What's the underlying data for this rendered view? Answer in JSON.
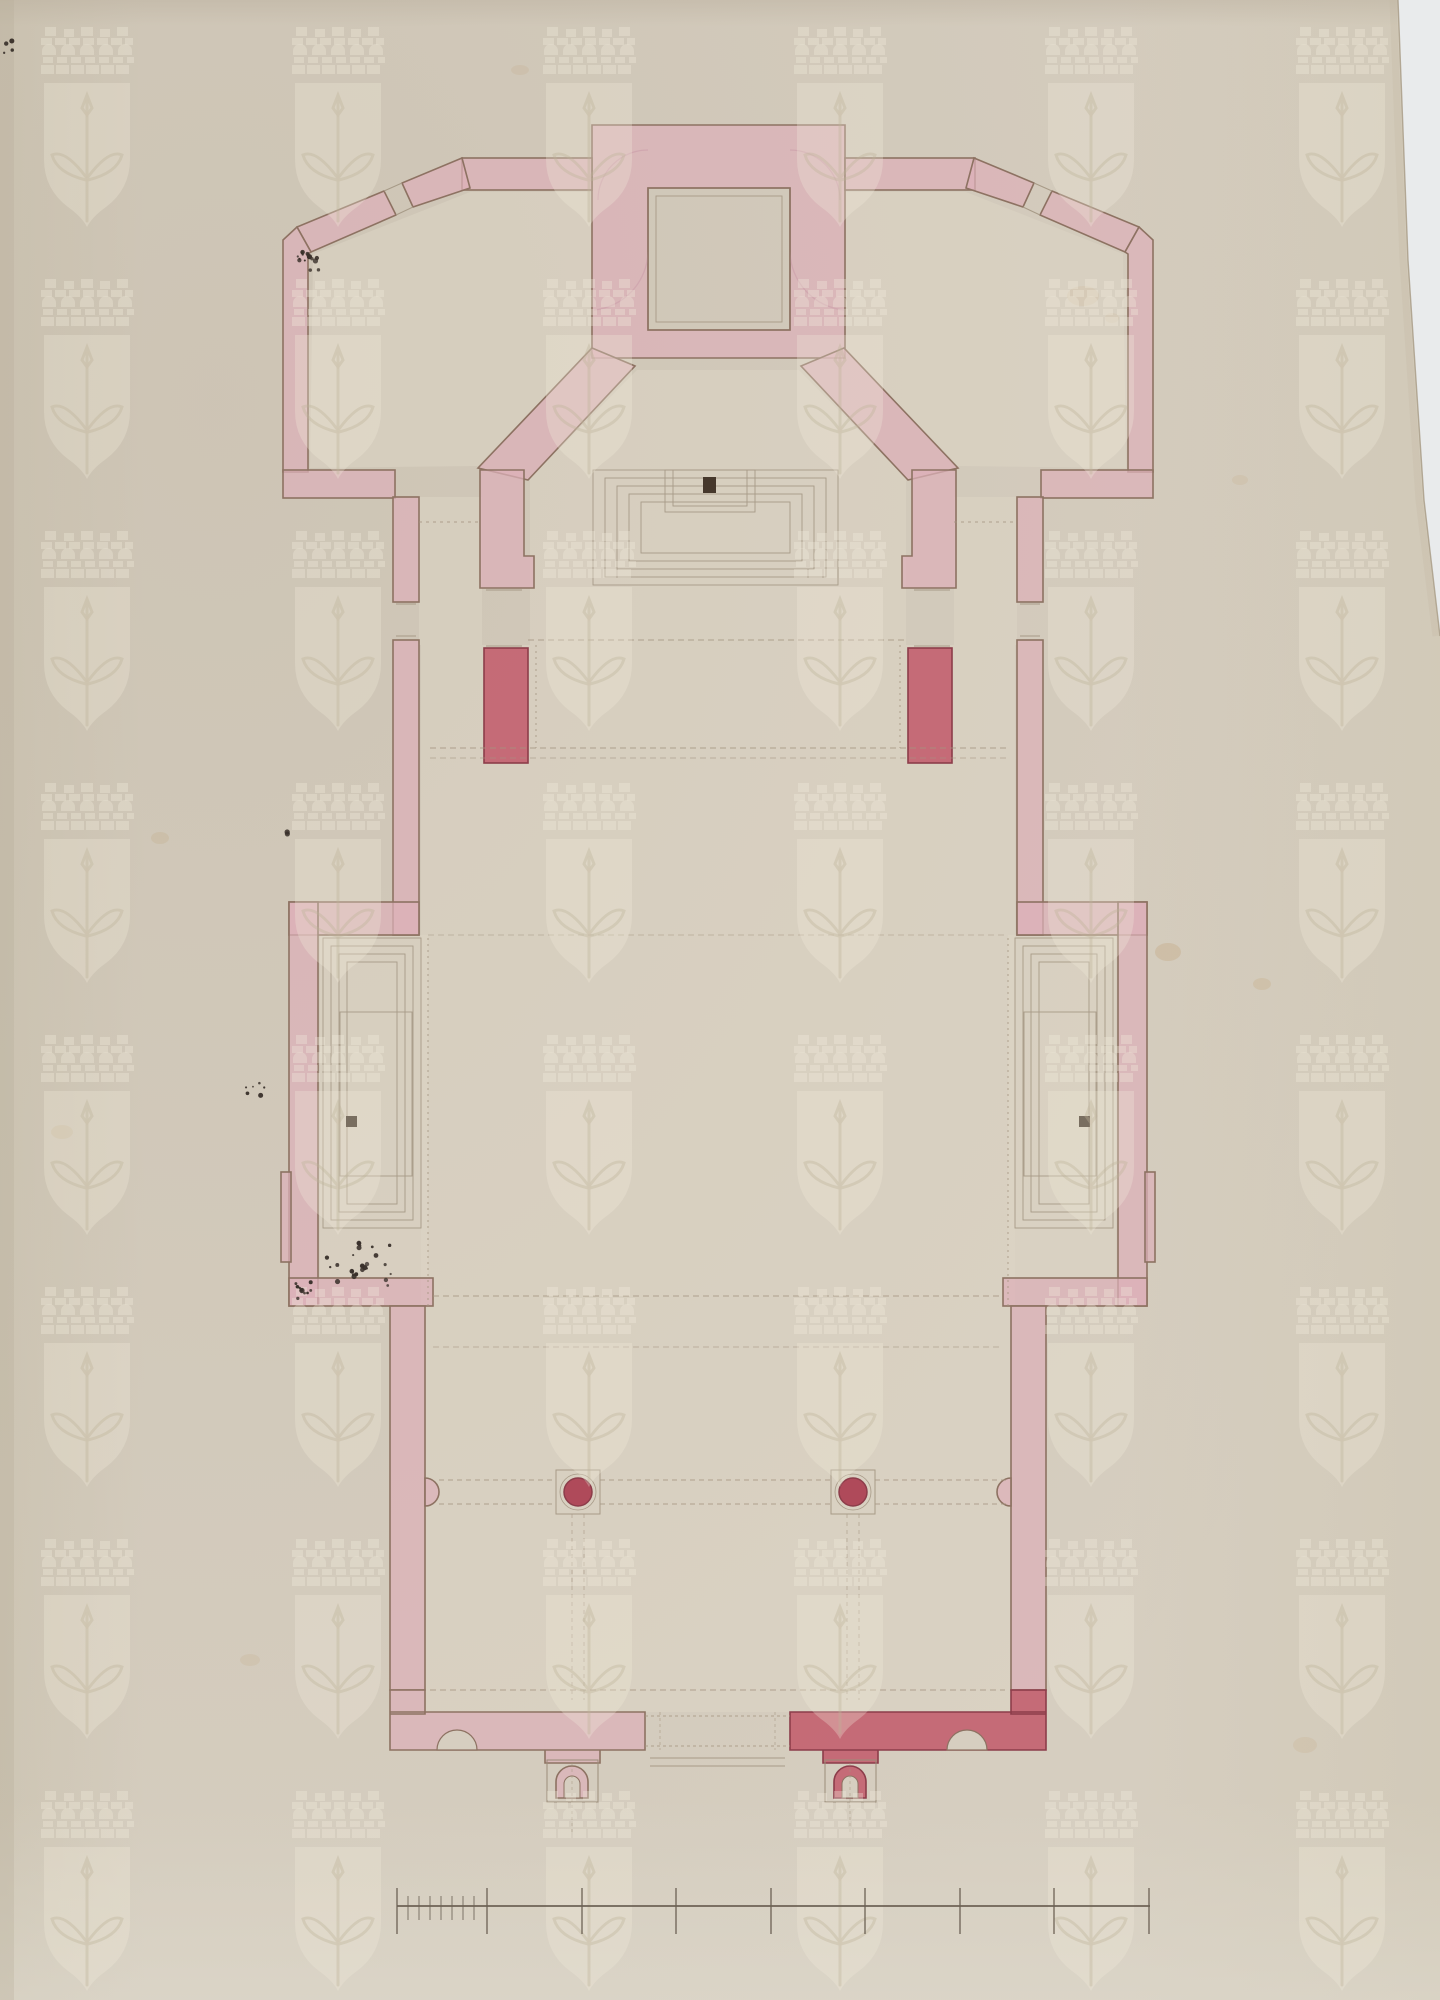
{
  "document": {
    "type": "scanned architectural drawing",
    "subject": "church floor plan, pink watercolor wash on aged laid paper with coat-of-arms watermark",
    "orientation": "portrait",
    "visible_text": "none (no legible lettering; scale bar has unlabeled tick marks)"
  },
  "palette": {
    "paper": "#d6cec0",
    "paper_edge_dark": "#a3957f",
    "scan_background": "#e9ebec",
    "floor_cream": "#ddd6c6",
    "wall_pink": "#dcb0b8",
    "wall_pink_light": "#e6c6ca",
    "wall_crimson": "#c2596a",
    "crimson_outline": "#8c3d4a",
    "column_red": "#ab3e51",
    "outline_brown": "#8d7262",
    "detail_line": "#a79a87",
    "dashed_line": "#a49480",
    "ink_speck": "#39302a",
    "altar_dark": "#46382c",
    "watermark_light": "#f2ecdc",
    "watermark_stroke": "#cdc2ab",
    "stain": "#b98d4e",
    "scale_bar_line": "#6b6053"
  },
  "watermark": {
    "motif": "shield with mural crown above, halberd inside shield (repeating papermaker watermark)",
    "tile_width": 251,
    "tile_height": 252,
    "origin_x": 37,
    "origin_y": 27,
    "opacity": 0.6
  },
  "plan": {
    "sections": [
      "sacristy-block",
      "corner-room-left",
      "corner-room-right",
      "chancel-apse",
      "side-corridor-left",
      "side-corridor-right",
      "nave-crossing",
      "side-chapel-left",
      "side-chapel-right",
      "vestibule",
      "entrance-front"
    ],
    "columns": {
      "count": 2,
      "radius": 14,
      "base_size": 44,
      "positions": [
        {
          "x": 578,
          "y": 1492
        },
        {
          "x": 853,
          "y": 1492
        }
      ]
    },
    "altars": [
      {
        "name": "high-altar",
        "x": 703,
        "y": 477,
        "w": 13,
        "h": 16
      },
      {
        "name": "side-altar-left",
        "x": 346,
        "y": 1116,
        "w": 11,
        "h": 11
      },
      {
        "name": "side-altar-right",
        "x": 1079,
        "y": 1116,
        "w": 11,
        "h": 11
      }
    ],
    "ink_spatter_clusters": [
      {
        "cx": 309,
        "cy": 256,
        "count": 15,
        "spread": 20,
        "seed": 7
      },
      {
        "cx": 362,
        "cy": 1266,
        "count": 28,
        "spread": 40,
        "seed": 13
      },
      {
        "cx": 300,
        "cy": 1292,
        "count": 10,
        "spread": 18,
        "seed": 21
      },
      {
        "cx": 258,
        "cy": 1088,
        "count": 6,
        "spread": 14,
        "seed": 5
      },
      {
        "cx": 288,
        "cy": 833,
        "count": 2,
        "spread": 6,
        "seed": 3
      },
      {
        "cx": 10,
        "cy": 45,
        "count": 4,
        "spread": 18,
        "seed": 9
      }
    ],
    "stains": [
      {
        "x": 1083,
        "y": 296,
        "rx": 16,
        "ry": 10,
        "o": 0.18
      },
      {
        "x": 1112,
        "y": 318,
        "rx": 7,
        "ry": 5,
        "o": 0.15
      },
      {
        "x": 1168,
        "y": 952,
        "rx": 13,
        "ry": 9,
        "o": 0.2
      },
      {
        "x": 1262,
        "y": 984,
        "rx": 9,
        "ry": 6,
        "o": 0.16
      },
      {
        "x": 160,
        "y": 838,
        "rx": 9,
        "ry": 6,
        "o": 0.12
      },
      {
        "x": 62,
        "y": 1132,
        "rx": 11,
        "ry": 7,
        "o": 0.12
      },
      {
        "x": 250,
        "y": 1660,
        "rx": 10,
        "ry": 6,
        "o": 0.1
      },
      {
        "x": 1305,
        "y": 1745,
        "rx": 12,
        "ry": 8,
        "o": 0.1
      },
      {
        "x": 520,
        "y": 70,
        "rx": 9,
        "ry": 5,
        "o": 0.1
      },
      {
        "x": 1240,
        "y": 480,
        "rx": 8,
        "ry": 5,
        "o": 0.1
      }
    ]
  },
  "scale_bar": {
    "y": 1906,
    "x_start": 397,
    "x_end": 1150,
    "major_ticks_x": [
      397,
      487,
      582,
      676,
      771,
      865,
      960,
      1054,
      1149
    ],
    "minor_ticks_x": [
      408,
      419,
      430,
      441,
      452,
      463,
      474
    ],
    "major_tick_up": 18,
    "major_tick_down": 28,
    "minor_tick_up": 10,
    "minor_tick_down": 14,
    "labels": "none legible"
  }
}
